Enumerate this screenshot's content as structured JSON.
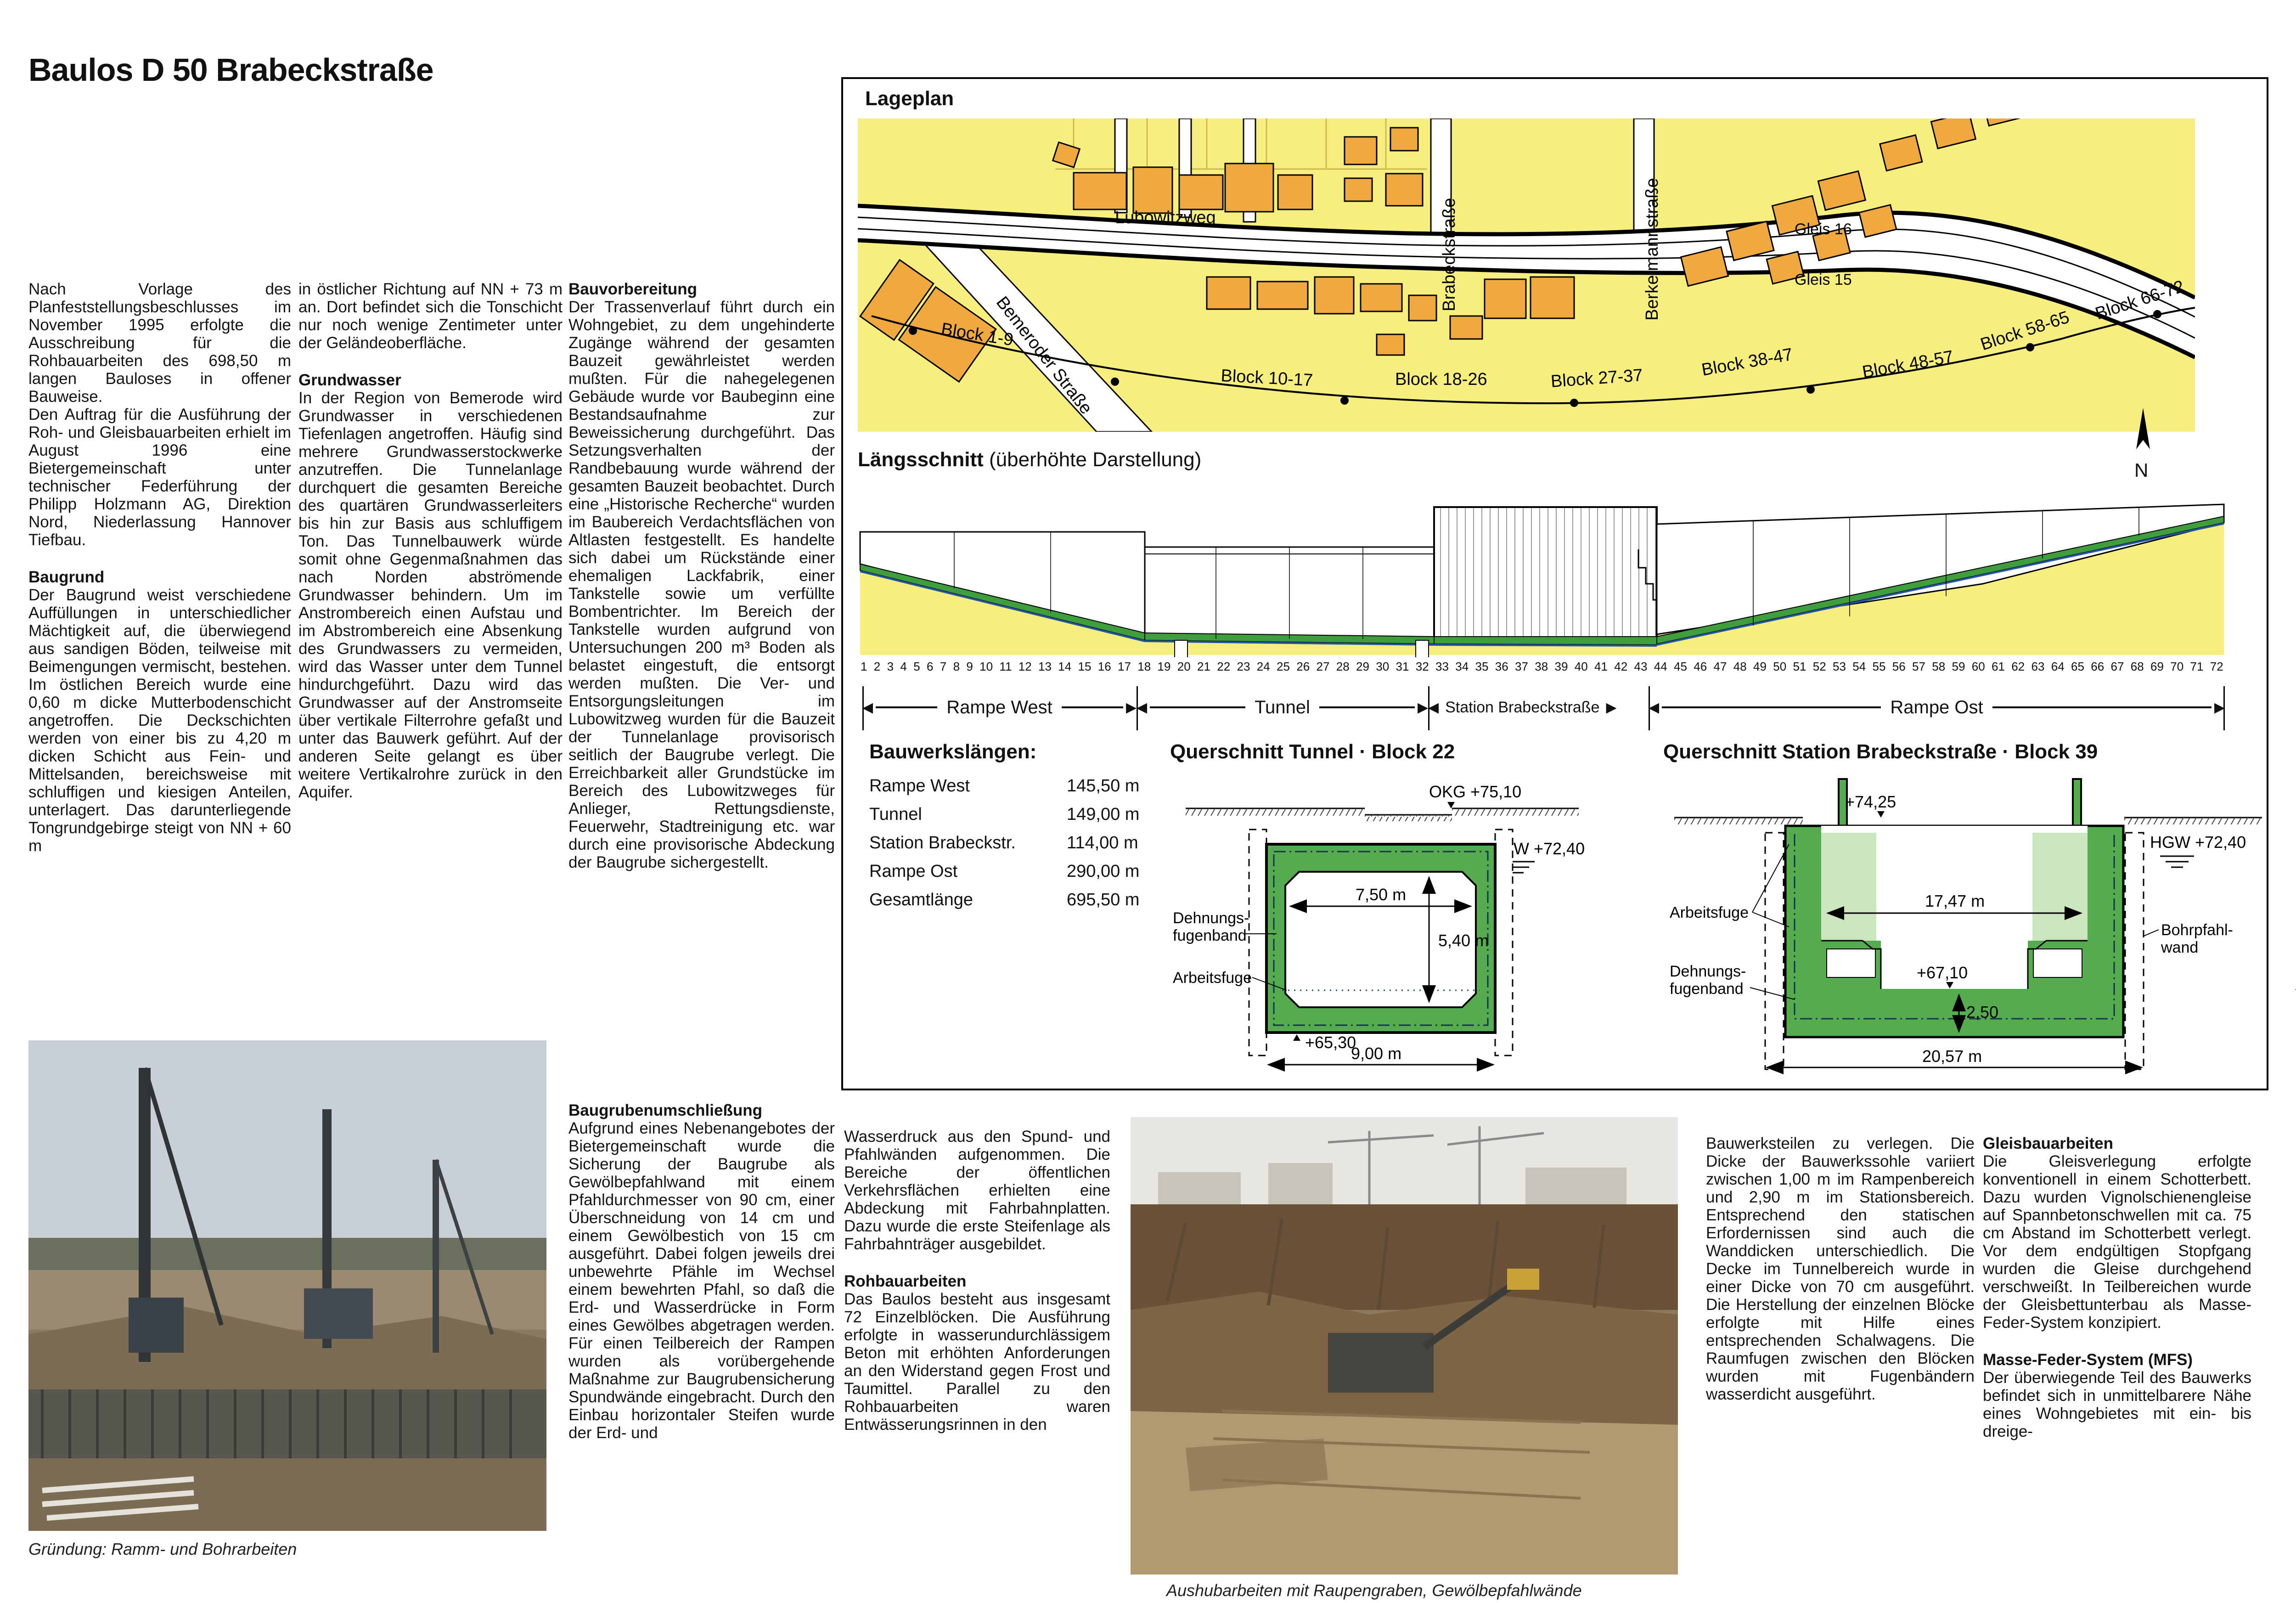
{
  "page": {
    "title": "Baulos D 50 Brabeckstraße"
  },
  "text": {
    "intro_p1": "Nach Vorlage des Planfeststellungsbeschlusses im November 1995 erfolgte die Ausschreibung für die Rohbauarbeiten des 698,50 m langen Bauloses in offener Bauweise.",
    "intro_p2": "Den Auftrag für die Ausführung der Roh- und Gleisbauarbeiten erhielt im August 1996 eine Bietergemeinschaft unter technischer Federführung der Philipp Holzmann AG, Direktion Nord, Niederlassung Hannover Tiefbau.",
    "baugrund": {
      "heading": "Baugrund",
      "body1": "Der Baugrund weist verschiedene Auffüllungen in unterschiedlicher Mächtigkeit auf, die überwiegend aus sandigen Böden, teilweise mit Beimengungen vermischt, bestehen. Im östlichen Bereich wurde eine 0,60 m dicke Mutterbodenschicht angetroffen. Die Deckschichten werden von einer bis zu 4,20 m dicken Schicht aus Fein- und Mittelsanden, bereichsweise mit schluffigen und kiesigen Anteilen, unterlagert. Das darunterliegende Tongrundgebirge steigt von NN + 60 m",
      "body2": "in östlicher Richtung auf NN + 73 m an. Dort befindet sich die Tonschicht nur noch wenige Zentimeter unter der Geländeoberfläche."
    },
    "grundwasser": {
      "heading": "Grundwasser",
      "body": "In der Region von Bemerode wird Grundwasser in verschiedenen Tiefenlagen angetroffen. Häufig sind mehrere Grundwasserstockwerke anzutreffen. Die Tunnelanlage durchquert die gesamten Bereiche des quartären Grundwasserleiters bis hin zur Basis aus schluffigem Ton. Das Tunnelbauwerk würde somit ohne Gegenmaßnahmen das nach Norden abströmende Grundwasser behindern. Um im Anstrombereich einen Aufstau und im Abstrombereich eine Absenkung des Grundwassers zu vermeiden, wird das Wasser unter dem Tunnel hindurchgeführt. Dazu wird das Grundwasser auf der Anstromseite über vertikale Filterrohre gefaßt und unter das Bauwerk geführt. Auf der anderen Seite gelangt es über weitere Vertikalrohre zurück in den Aquifer."
    },
    "bauvorbereitung": {
      "heading": "Bauvorbereitung",
      "body": "Der Trassenverlauf führt durch ein Wohngebiet, zu dem ungehinderte Zugänge während der gesamten Bauzeit gewährleistet werden mußten. Für die nahegelegenen Gebäude wurde vor Baubeginn eine Bestandsaufnahme zur Beweissicherung durchgeführt. Das Setzungsverhalten der Randbebauung wurde während der gesamten Bauzeit beobachtet. Durch eine „Historische Recherche“ wurden im Baubereich Verdachtsflächen von Altlasten festgestellt. Es handelte sich dabei um Rückstände einer ehemaligen Lackfabrik, einer Tankstelle sowie um verfüllte Bombentrichter. Im Bereich der Tankstelle wurden aufgrund von Untersuchungen 200 m³ Boden als belastet eingestuft, die entsorgt werden mußten. Die Ver- und Entsorgungsleitungen im Lubowitzweg wurden für die Bauzeit der Tunnelanlage provisorisch seitlich der Baugrube verlegt. Die Erreichbarkeit aller Grundstücke im Bereich des Lubowitzweges für Anlieger, Rettungsdienste, Feuerwehr, Stadtreinigung etc. war durch eine provisorische Abdeckung der Baugrube sichergestellt."
    },
    "baugrubenumschliessung": {
      "heading": "Baugrubenumschließung",
      "body1": "Aufgrund eines Nebenangebotes der Bietergemeinschaft wurde die Sicherung der Baugrube als Gewölbepfahlwand mit einem Pfahldurchmesser von 90 cm, einer Überschneidung von 14 cm und einem Gewölbestich von 15 cm ausgeführt. Dabei folgen jeweils drei unbewehrte Pfähle im Wechsel einem bewehrten Pfahl, so daß die Erd- und Wasserdrücke in Form eines Gewölbes abgetragen werden. Für einen Teilbereich der Rampen wurden als vorübergehende Maßnahme zur Baugrubensicherung Spundwände eingebracht. Durch den Einbau horizontaler Steifen wurde der Erd- und",
      "body2": "Wasserdruck aus den Spund- und Pfahlwänden aufgenommen. Die Bereiche der öffentlichen Verkehrsflächen erhielten eine Abdeckung mit Fahrbahnplatten. Dazu wurde die erste Steifenlage als Fahrbahnträger ausgebildet."
    },
    "rohbauarbeiten": {
      "heading": "Rohbauarbeiten",
      "body1": "Das Baulos besteht aus insgesamt 72 Einzelblöcken. Die Ausführung erfolgte in wasserundurchlässigem Beton mit erhöhten Anforderungen an den Widerstand gegen Frost und Taumittel. Parallel zu den Rohbauarbeiten waren Entwässerungsrinnen in den",
      "body2": "Bauwerksteilen zu verlegen. Die Dicke der Bauwerkssohle variiert zwischen 1,00 m im Rampenbereich und 2,90 m im Stationsbereich. Entsprechend den statischen Erfordernissen sind auch die Wanddicken unterschiedlich. Die Decke im Tunnelbereich wurde in einer Dicke von 70 cm ausgeführt. Die Herstellung der einzelnen Blöcke erfolgte mit Hilfe eines entsprechenden Schalwagens. Die Raumfugen zwischen den Blöcken wurden mit Fugenbändern wasserdicht ausgeführt."
    },
    "gleisbauarbeiten": {
      "heading": "Gleisbauarbeiten",
      "body": "Die Gleisverlegung erfolgte konventionell in einem Schotterbett. Dazu wurden Vignolschienengleise auf Spannbetonschwellen mit ca. 75 cm Abstand im Schotterbett verlegt. Vor dem endgültigen Stopfgang wurden die Gleise durchgehend verschweißt. In Teilbereichen wurde der Gleisbettunterbau als Masse-Feder-System konzipiert."
    },
    "mfs": {
      "heading": "Masse-Feder-System (MFS)",
      "body1": "Der überwiegende Teil des Bauwerks befindet sich in unmittelbarere Nähe eines Wohngebietes mit ein- bis dreige-",
      "body2": "schossiger Bebauung. Um die Belastungen der Anwohner aus dem Stadtbahnbetrieb so gering wie möglich zu halten, wurde für diesen Bereich der Einbau eines Masse-Feder-Systems vorgesehen. Dieser Bauwerksabschnitt besteht zum Teil aus geschlossenen Tunnelblöcken und im Rand- und Mittelbereich aus offenen Blöcken. Das MFS setzt sich aus Betontrögen zusammen, die jeweils auf vier punktförmigen, dauerelastischen Lagern ruhen. Die Tröge wurden als Stahlbetonfertigteile mit einer Betongüte B35 konzipiert und tragen den in Schotter verlegten Gleisrost. An den Übergängen zwischen den Trogelementen müssen größere Differenzeinfederungen vermieden werden. Dazu wurden die Fugen so ausgebildet, daß Querkräfte übertragen werden können, ohne die Längsverschieblichkeit der Elemente für den Dehnungsausgleich aus Temperatur zu beeinträchtigen. Als zusätzlicher Schutz gegen den Luftschall wurden Holzschwellen eingebaut und an den Wänden der Westrampe schallabsorbierende Verkleidungen aufgebracht."
    },
    "ausblick": {
      "heading": "Ausblick",
      "body1": "Nach Beendigung der Rohbauarbeiten im Stationsbereich wird mit den Ausbauarbeiten begonnen. Die Aufzugsanlagen werden neben den Zugängen zur Brabeckstraße eingebaut und verbinden die Seitenbahnsteige",
      "body2": "direkt mit der öffentlichen Verkehrsfläche. Zur subjektiven Sicherheit werden die Aufzugsanlagen und die Bahnsteigüberdachungen voll verglast. Der Tunnelabschnitt wird 1999, also rechtzeitig vor Beginn der Weltausstellung EXPO 2000, fertiggestellt."
    }
  },
  "captions": {
    "photo_left": "Gründung: Ramm- und Bohrarbeiten",
    "photo_middle": "Aushubarbeiten mit Raupengraben, Gewölbepfahlwände"
  },
  "lageplan": {
    "title": "Lageplan",
    "bemeroder": "Bemeroder Straße",
    "lubowitzweg": "Lubowitzweg",
    "brabeckstrasse": "Brabeckstraße",
    "berkelmannstrasse": "Berkelmannstraße",
    "gleis16": "Gleis 16",
    "gleis15": "Gleis 15",
    "north": "N",
    "blocks": [
      "Block 1-9",
      "Block 10-17",
      "Block 18-26",
      "Block 27-37",
      "Block 38-47",
      "Block 48-57",
      "Block 58-65",
      "Block 66-72"
    ]
  },
  "laengsschnitt": {
    "title": "Längsschnitt",
    "subtitle": " (überhöhte Darstellung)",
    "sections": [
      "Rampe West",
      "Tunnel",
      "Station Brabeckstraße",
      "Rampe Ost"
    ],
    "numbers": [
      "1",
      "2",
      "3",
      "4",
      "5",
      "6",
      "7",
      "8",
      "9",
      "10",
      "11",
      "12",
      "13",
      "14",
      "15",
      "16",
      "17",
      "18",
      "19",
      "20",
      "21",
      "22",
      "23",
      "24",
      "25",
      "26",
      "27",
      "28",
      "29",
      "30",
      "31",
      "32",
      "33",
      "34",
      "35",
      "36",
      "37",
      "38",
      "39",
      "40",
      "41",
      "42",
      "43",
      "44",
      "45",
      "46",
      "47",
      "48",
      "49",
      "50",
      "51",
      "52",
      "53",
      "54",
      "55",
      "56",
      "57",
      "58",
      "59",
      "60",
      "61",
      "62",
      "63",
      "64",
      "65",
      "66",
      "67",
      "68",
      "69",
      "70",
      "71",
      "72"
    ]
  },
  "bauwerkslaengen": {
    "title": "Bauwerkslängen:",
    "rows": [
      {
        "label": "Rampe West",
        "value": "145,50 m"
      },
      {
        "label": "Tunnel",
        "value": "149,00 m"
      },
      {
        "label": "Station Brabeckstr.",
        "value": "114,00 m"
      },
      {
        "label": "Rampe Ost",
        "value": "290,00 m"
      },
      {
        "label": "Gesamtlänge",
        "value": "695,50 m"
      }
    ]
  },
  "querschnitt_tunnel": {
    "title": "Querschnitt Tunnel · Block 22",
    "okg": "OKG +75,10",
    "hgw": "HGW +72,40",
    "w_inner": "7,50 m",
    "h_inner": "5,40 m",
    "level_floor": "+65,30",
    "w_outer": "9,00 m",
    "lbl_dehnungs_1": "Dehnungs-",
    "lbl_dehnungs_2": "fugenband",
    "lbl_arbeitsfuge": "Arbeitsfuge"
  },
  "querschnitt_station": {
    "title": "Querschnitt Station Brabeckstraße · Block 39",
    "level_top": "+74,25",
    "hgw": "HGW +72,40",
    "w_inner": "17,47 m",
    "level_floor": "+67,10",
    "d_floor": "2,50",
    "w_outer": "20,57 m",
    "lbl_arbeitsfuge": "Arbeitsfuge",
    "lbl_dehnungs_1": "Dehnungs-",
    "lbl_dehnungs_2": "fugenband",
    "lbl_bohrpfahl_1": "Bohrpfahl-",
    "lbl_bohrpfahl_2": "wand"
  },
  "bauzeitenplan": {
    "title": "Bauzeitenplan",
    "axis_label": "Baublock",
    "block_ticks": [
      "1",
      "3",
      "5",
      "7",
      "9",
      "11",
      "13",
      "15",
      "17",
      "19",
      "21",
      "23",
      "25",
      "27",
      "29",
      "31",
      "33",
      "37",
      "41",
      "43",
      "45",
      "47",
      "49",
      "51",
      "53",
      "55",
      "57",
      "59",
      "61",
      "63",
      "65",
      "67",
      "69",
      "71",
      "72"
    ],
    "months": [
      "Juli",
      "Aug.",
      "Sept.",
      "Okt.",
      "Nov.",
      "Dez.",
      "Jan.",
      "Febr.",
      "März",
      "Apr.",
      "Mai",
      "Juni",
      "Juli",
      "Aug.",
      "Sept.",
      "Okt.",
      "Nov.",
      "Dez.",
      "Jan.",
      "Febr.",
      "März",
      "Apr.",
      "Mai",
      "Juni",
      "Juli",
      "Aug.",
      "Sept.",
      "Okt.",
      "Nov.",
      "Dez."
    ],
    "years": [
      "1996",
      "1997",
      "1998"
    ],
    "sections": [
      "Rampe West",
      "Tunnel",
      "Station",
      "Rampe Ost"
    ],
    "legend": [
      {
        "label": "Leitungs- und Kabelverlegungen",
        "type": "hatch-red"
      },
      {
        "label": "Aushub",
        "type": "orange"
      },
      {
        "label": "Stahlbetonarbeiten",
        "type": "green"
      },
      {
        "label": "Bohrpfahlwand",
        "type": "dots"
      },
      {
        "label": "Masse-Feder-System",
        "type": "blue"
      },
      {
        "label": "Gleisbau",
        "type": "gray"
      }
    ],
    "activities": [
      {
        "activity": "Leitungs- und Kabelverlegungen",
        "blocks": "12-28",
        "period": "Okt.-Dez. 1996"
      },
      {
        "activity": "Aushub",
        "blocks": "36-59",
        "period": "Sept.-Okt. 1996"
      },
      {
        "activity": "Aushub",
        "blocks": "15-59",
        "period": "Febr.-Aug. 1997"
      },
      {
        "activity": "Aushub",
        "blocks": "1-14",
        "period": "Juni-Dez. 1997"
      },
      {
        "activity": "Aushub",
        "blocks": "60-72",
        "period": "Aug. 1997-Febr. 1998"
      },
      {
        "activity": "Bohrpfahlwand",
        "blocks": "50-59",
        "period": "Nov.-Dez. 1996"
      },
      {
        "activity": "Bohrpfahlwand",
        "blocks": "30-46",
        "period": "Dez. 1996-Apr. 1997"
      },
      {
        "activity": "Bohrpfahlwand",
        "blocks": "11-27",
        "period": "Febr.-Apr. 1997"
      },
      {
        "activity": "Stahlbetonarbeiten",
        "blocks": "1-72",
        "period": "Jan. 1997-Juni 1998"
      },
      {
        "activity": "Masse-Feder-System",
        "blocks": "15-29 (Tunnel)",
        "period": "Mai-Juli 1998"
      },
      {
        "activity": "Masse-Feder-System",
        "blocks": "30-44 (Station)",
        "period": "Mai-Juni 1998"
      },
      {
        "activity": "Masse-Feder-System",
        "blocks": "1-14 (Rampe West)",
        "period": "Juli-Sept. 1998"
      },
      {
        "activity": "Gleisbau",
        "blocks": "30-65",
        "period": "Juli-Sept. 1998"
      },
      {
        "activity": "Gleisbau",
        "blocks": "1-29",
        "period": "Sept.-Nov. 1998"
      }
    ]
  },
  "mfs_diagram": {
    "title": "Masse-Feder-System",
    "subtitle": " (abgefedertes Gleissystem)",
    "area_label": "im Tunnelbereich",
    "dir_left": "Süd",
    "dir_right": "Nord",
    "lbl_betontrog": "Betontrog",
    "lbl_lager": "dauerelastisches Lager"
  }
}
